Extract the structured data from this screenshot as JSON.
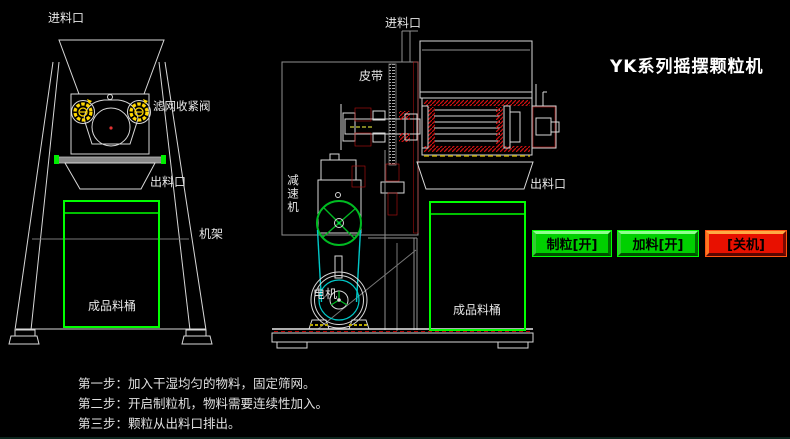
{
  "title": "YK系列摇摆颗粒机",
  "left_view": {
    "inlet_label": "进料口",
    "filter_valve_label": "滤网收紧阀",
    "outlet_label": "出料口",
    "frame_label": "机架",
    "barrel_label": "成品料桶"
  },
  "section_view": {
    "inlet_label": "进料口",
    "belt_label": "皮带",
    "reducer_label": "减速机",
    "motor_label": "电机",
    "outlet_label": "出料口",
    "barrel_label": "成品料桶"
  },
  "controls": {
    "buttons": [
      {
        "id": "granulate-on",
        "label": "制粒[开]",
        "state": "on",
        "color": "#00d000"
      },
      {
        "id": "feed-on",
        "label": "加料[开]",
        "state": "on",
        "color": "#00d000"
      },
      {
        "id": "power-off",
        "label": "[关机]",
        "state": "off",
        "color": "#e81000"
      }
    ]
  },
  "instructions": [
    "第一步：加入干湿均匀的物料，固定筛网。",
    "第二步：开启制粒机，物料需要连续性加入。",
    "第三步：颗粒从出料口排出。"
  ],
  "colors": {
    "accent_green": "#00ff00",
    "button_green_face": "#00d000",
    "button_red_face": "#e81000",
    "belt_cyan": "#00c8c8",
    "knob_yellow": "#ffd700",
    "hatch_red": "#cc1111"
  }
}
